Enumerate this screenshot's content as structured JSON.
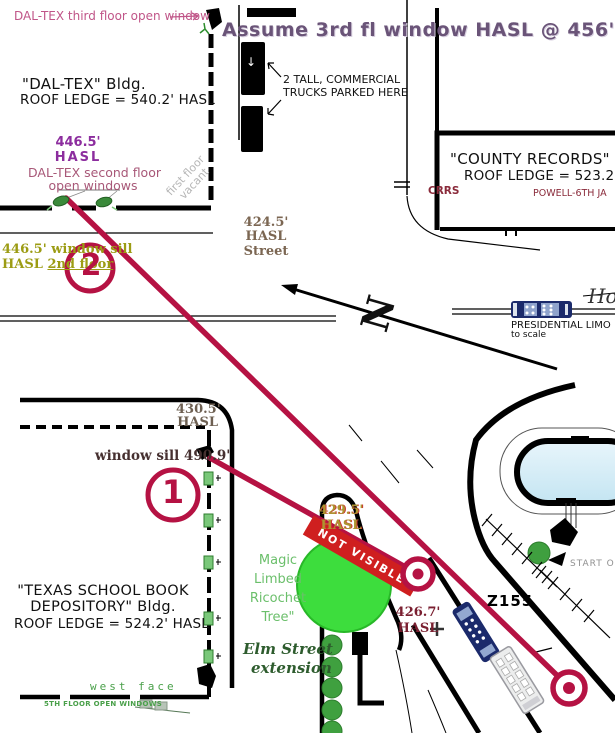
{
  "colors": {
    "trajectory_red": "#b51243",
    "banner_red": "#cf1f1f",
    "tree_green": "#3ddd3d",
    "purple_heading": "#6a5478",
    "purple_hasl": "#8c2d9e",
    "pink_label": "#c05588",
    "olive_label": "#9c9c14",
    "dark_red_label": "#7a1f30",
    "green_label": "#4aa04a",
    "limo_navy": "#1b2a6b",
    "pool_blue": "#d9eef7"
  },
  "header": {
    "assume_note": "Assume 3rd fl window HASL @ 456'"
  },
  "dal_tex": {
    "third_floor_label": "DAL-TEX third floor open window",
    "name_line": "\"DAL-TEX\" Bldg.",
    "roof_line": "ROOF LEDGE = 540.2' HASL",
    "hasl_value": "446.5'",
    "hasl_word": "HASL",
    "second_floor_line1": "DAL-TEX second floor",
    "second_floor_line2": "open windows",
    "sill_line1": "446.5' window sill",
    "sill_line2_word": "HASL",
    "sill_line2_floor": "2nd floor",
    "first_floor_line1": "first floor",
    "first_floor_line2": "vacant"
  },
  "houston_street": {
    "trucks_line1": "2 TALL, COMMERCIAL",
    "trucks_line2": "TRUCKS PARKED HERE",
    "truck_arrow": "↓",
    "hasl424_value": "424.5'",
    "hasl424_word": "HASL",
    "street_word": "Street"
  },
  "county_records": {
    "name_line": "\"COUNTY RECORDS\" Bldg.",
    "roof_line": "ROOF LEDGE = 523.2' HASL",
    "crrs": "CRRS",
    "powell": "POWELL-6TH JA"
  },
  "compass": {
    "n": "N"
  },
  "limo_legend": {
    "line1": "PRESIDENTIAL LIMO",
    "line2": "to scale"
  },
  "street_label_h": "Ho",
  "tsbd": {
    "corner_hasl_value": "430.5'",
    "corner_hasl_word": "HASL",
    "window_sill": "window sill 490.9'",
    "name_line1": "\"TEXAS SCHOOL BOOK",
    "name_line2": "DEPOSITORY\" Bldg.",
    "roof_line": "ROOF LEDGE = 524.2' HASL",
    "west_face": "west face",
    "fifth_floor": "5TH FLOOR OPEN WINDOWS"
  },
  "trajectories": {
    "circle1": "1",
    "circle2": "2"
  },
  "tree": {
    "lines": [
      "Magic",
      "Limbed",
      "Ricochet",
      "Tree\""
    ],
    "not_visible": "NOT VISIBLE",
    "hasl429_value": "429.5'",
    "hasl429_word": "HASL"
  },
  "elm_extension": {
    "line1": "Elm Street",
    "line2": "extension"
  },
  "annotations": {
    "z_frame": "Z155",
    "hasl426_value": "426.7'",
    "hasl426_word": "HASL",
    "start_label": "START O"
  }
}
